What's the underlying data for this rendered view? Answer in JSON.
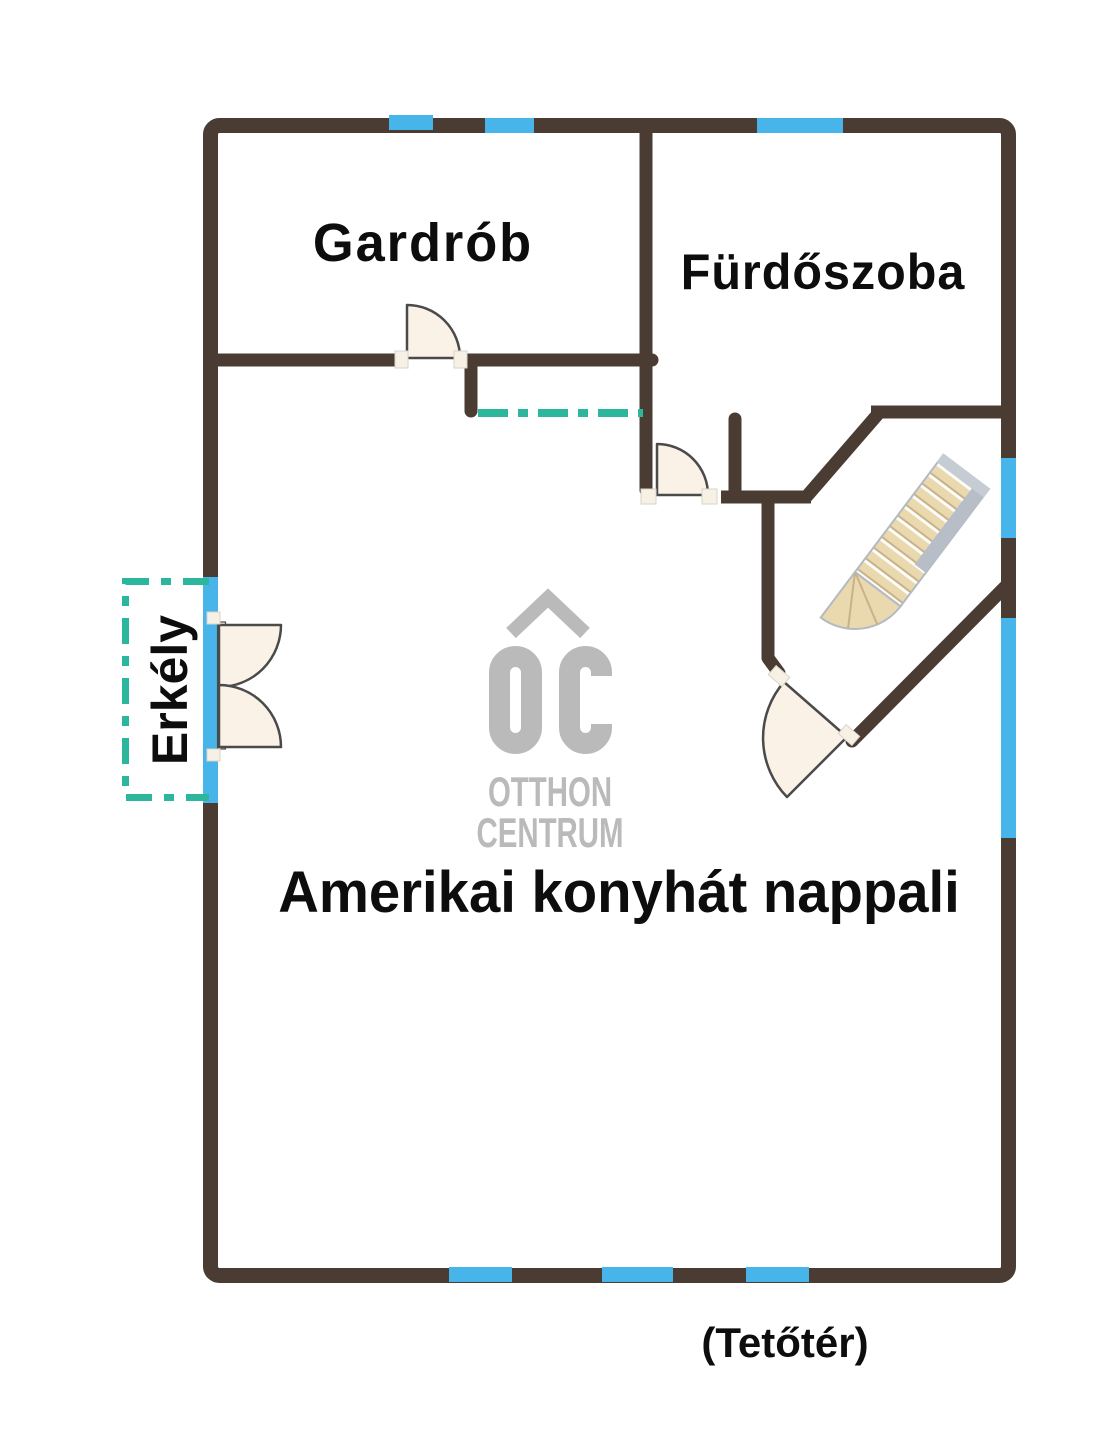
{
  "plan": {
    "rooms": [
      {
        "id": "gardrob",
        "label": "Gardrób"
      },
      {
        "id": "furdoszoba",
        "label": "Fürdőszoba"
      },
      {
        "id": "nappali",
        "label": "Amerikai konyhát nappali"
      },
      {
        "id": "erkely",
        "label": "Erkély"
      }
    ],
    "footnote": "(Tetőtér)"
  },
  "logo": {
    "line1": "OTTHON",
    "line2": "CENTRUM"
  },
  "colors": {
    "wall": "#4A3C33",
    "window": "#47B5EA",
    "balcony": "#2CB69C",
    "logo": "#BABABA",
    "doorFill": "#FAF2E7",
    "doorStroke": "#4A4A4A",
    "stairWood": "#EAD8AE",
    "stairGray": "#B7BEC7"
  }
}
